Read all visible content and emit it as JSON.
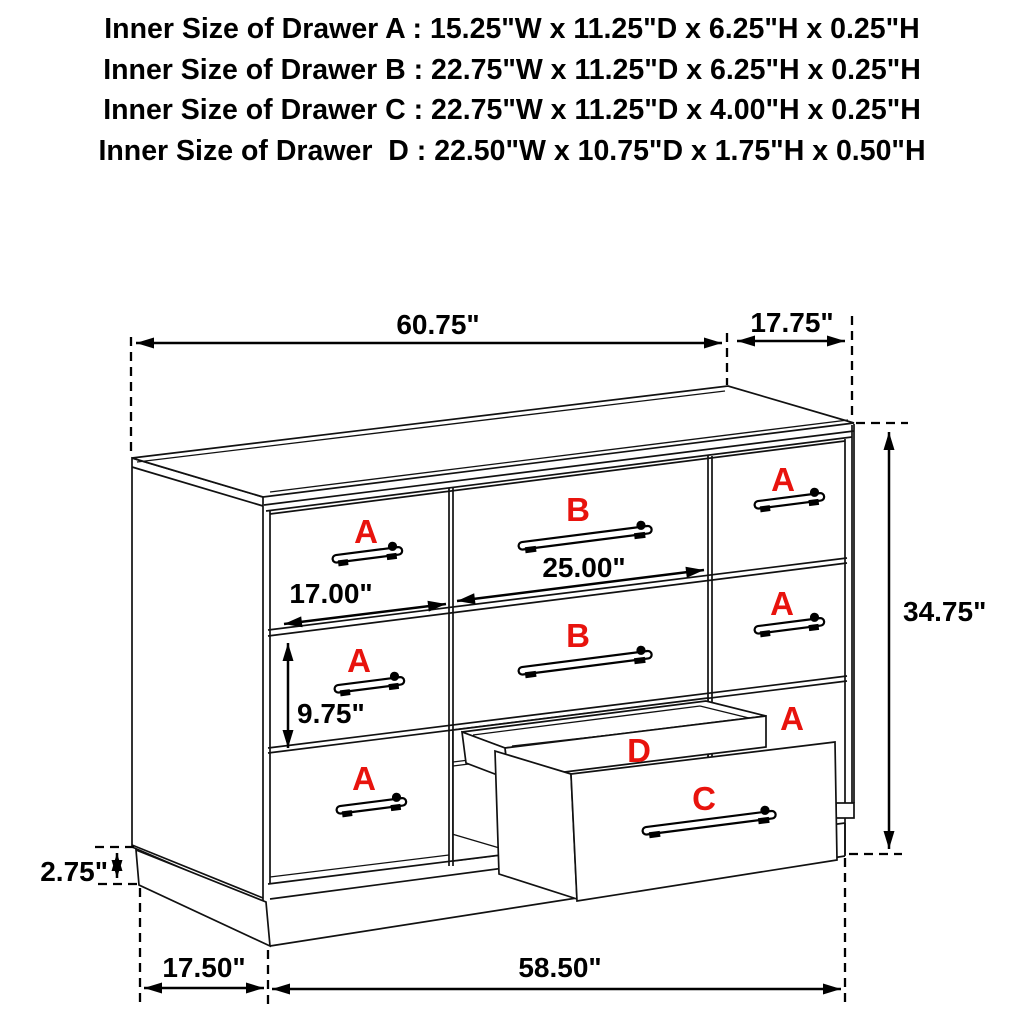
{
  "specs": {
    "lines": [
      "Inner Size of Drawer A : 15.25\"W x 11.25\"D x 6.25\"H x 0.25\"H",
      "Inner Size of Drawer B : 22.75\"W x 11.25\"D x 6.25\"H x 0.25\"H",
      "Inner Size of Drawer C : 22.75\"W x 11.25\"D x 4.00\"H x 0.25\"H",
      "Inner Size of Drawer  D : 22.50\"W x 10.75\"D x 1.75\"H x 0.50\"H"
    ]
  },
  "diagram": {
    "dimensions": {
      "top_width": "60.75\"",
      "top_depth": "17.75\"",
      "overall_height": "34.75\"",
      "center_drawer_width": "25.00\"",
      "left_drawer_width": "17.00\"",
      "drawer_height": "9.75\"",
      "base_height": "2.75\"",
      "base_depth": "17.50\"",
      "base_width": "58.50\""
    },
    "drawer_labels": {
      "left_column": [
        "A",
        "A",
        "A"
      ],
      "center_column": [
        "B",
        "B"
      ],
      "right_column": [
        "A",
        "A",
        "A"
      ],
      "pullout_shallow": "D",
      "pullout_deep": "C"
    },
    "label_color": "#e8130d"
  }
}
